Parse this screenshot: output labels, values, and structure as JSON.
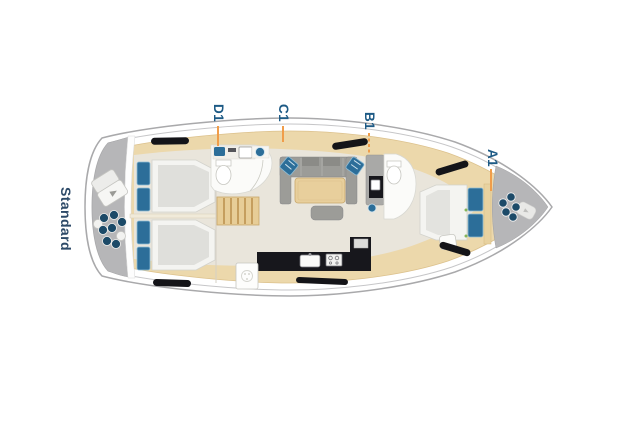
{
  "layout": {
    "name": "Standard"
  },
  "cabins": [
    {
      "id": "D1",
      "label": "D1"
    },
    {
      "id": "C1",
      "label": "C1"
    },
    {
      "id": "B1",
      "label": "B1"
    },
    {
      "id": "A1",
      "label": "A1"
    }
  ],
  "colors": {
    "cabin_label_text": "#1d5a85",
    "layout_label_text": "#2d4a68",
    "leader_line": "#f09d4a",
    "pillow_blue": "#2c6e99",
    "fender_navy": "#1c4a68",
    "hull_gray": "#b6b6b8",
    "deck_tan": "#ecd8ab",
    "floor_beige": "#e9e5db",
    "sofa_gray": "#9c9c98",
    "galley_black": "#17171c"
  },
  "icons": {
    "stern": [
      "life-raft-icon",
      "fender-cluster-icon"
    ],
    "bow": [
      "fender-cluster-icon",
      "windlass-icon"
    ]
  }
}
